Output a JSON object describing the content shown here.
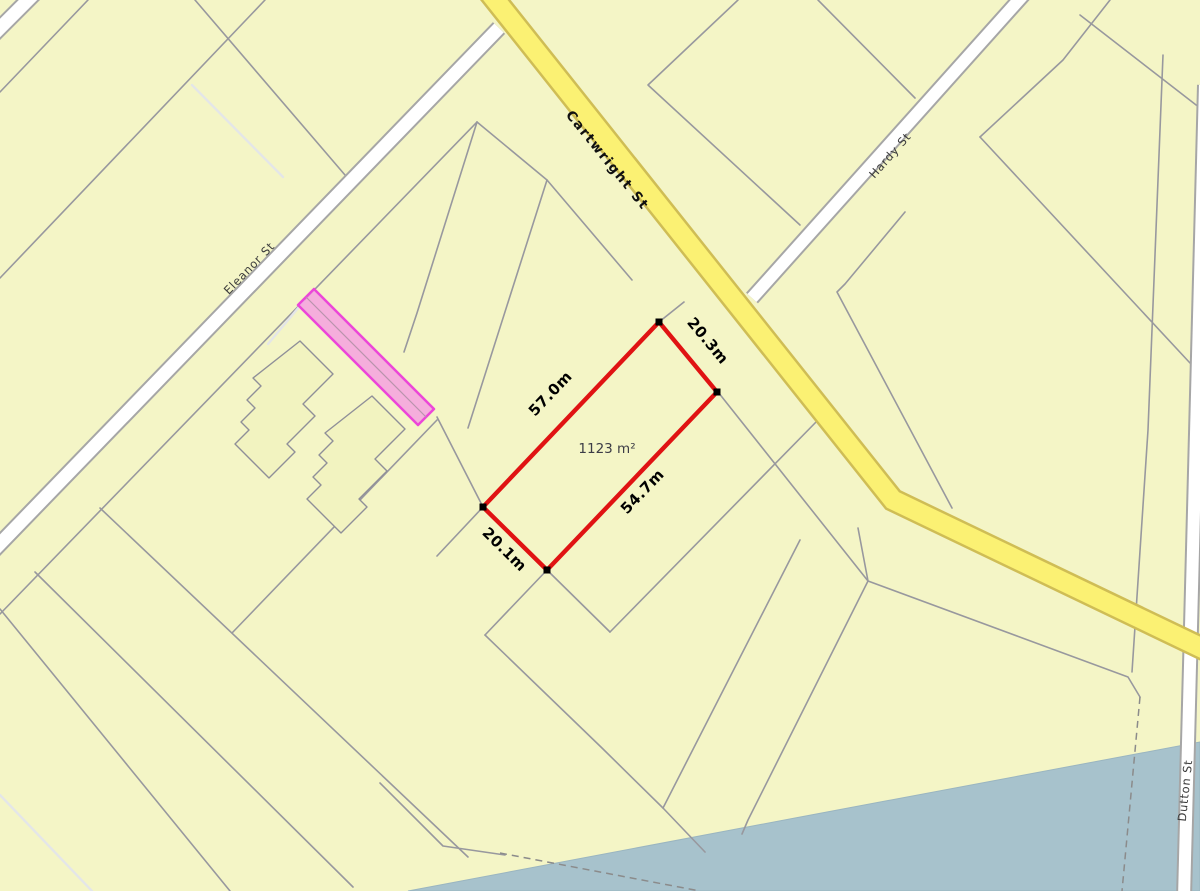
{
  "map": {
    "colors": {
      "background": "#f4f5c6",
      "parcel_line": "#98989e",
      "water": "#a7c2cc",
      "road_yellow_fill": "#fbf173",
      "road_yellow_casing": "#cfbd55",
      "road_white_fill": "#ffffff",
      "road_white_casing": "#a6a6a6",
      "highlight_outline": "#e01313",
      "strip_fill": "#f59ce1",
      "strip_stroke": "#ec46d8"
    },
    "streets": {
      "cartwright": {
        "label": "Cartwright St"
      },
      "eleanor": {
        "label": "Eleanor St"
      },
      "hardy": {
        "label": "Hardy St"
      },
      "dutton": {
        "label": "Dutton St"
      }
    },
    "highlight_plot": {
      "area_label": "1123 m²",
      "dimensions": {
        "nw_side": "57.0m",
        "ne_side": "20.3m",
        "se_side": "54.7m",
        "sw_side": "20.1m"
      }
    }
  }
}
